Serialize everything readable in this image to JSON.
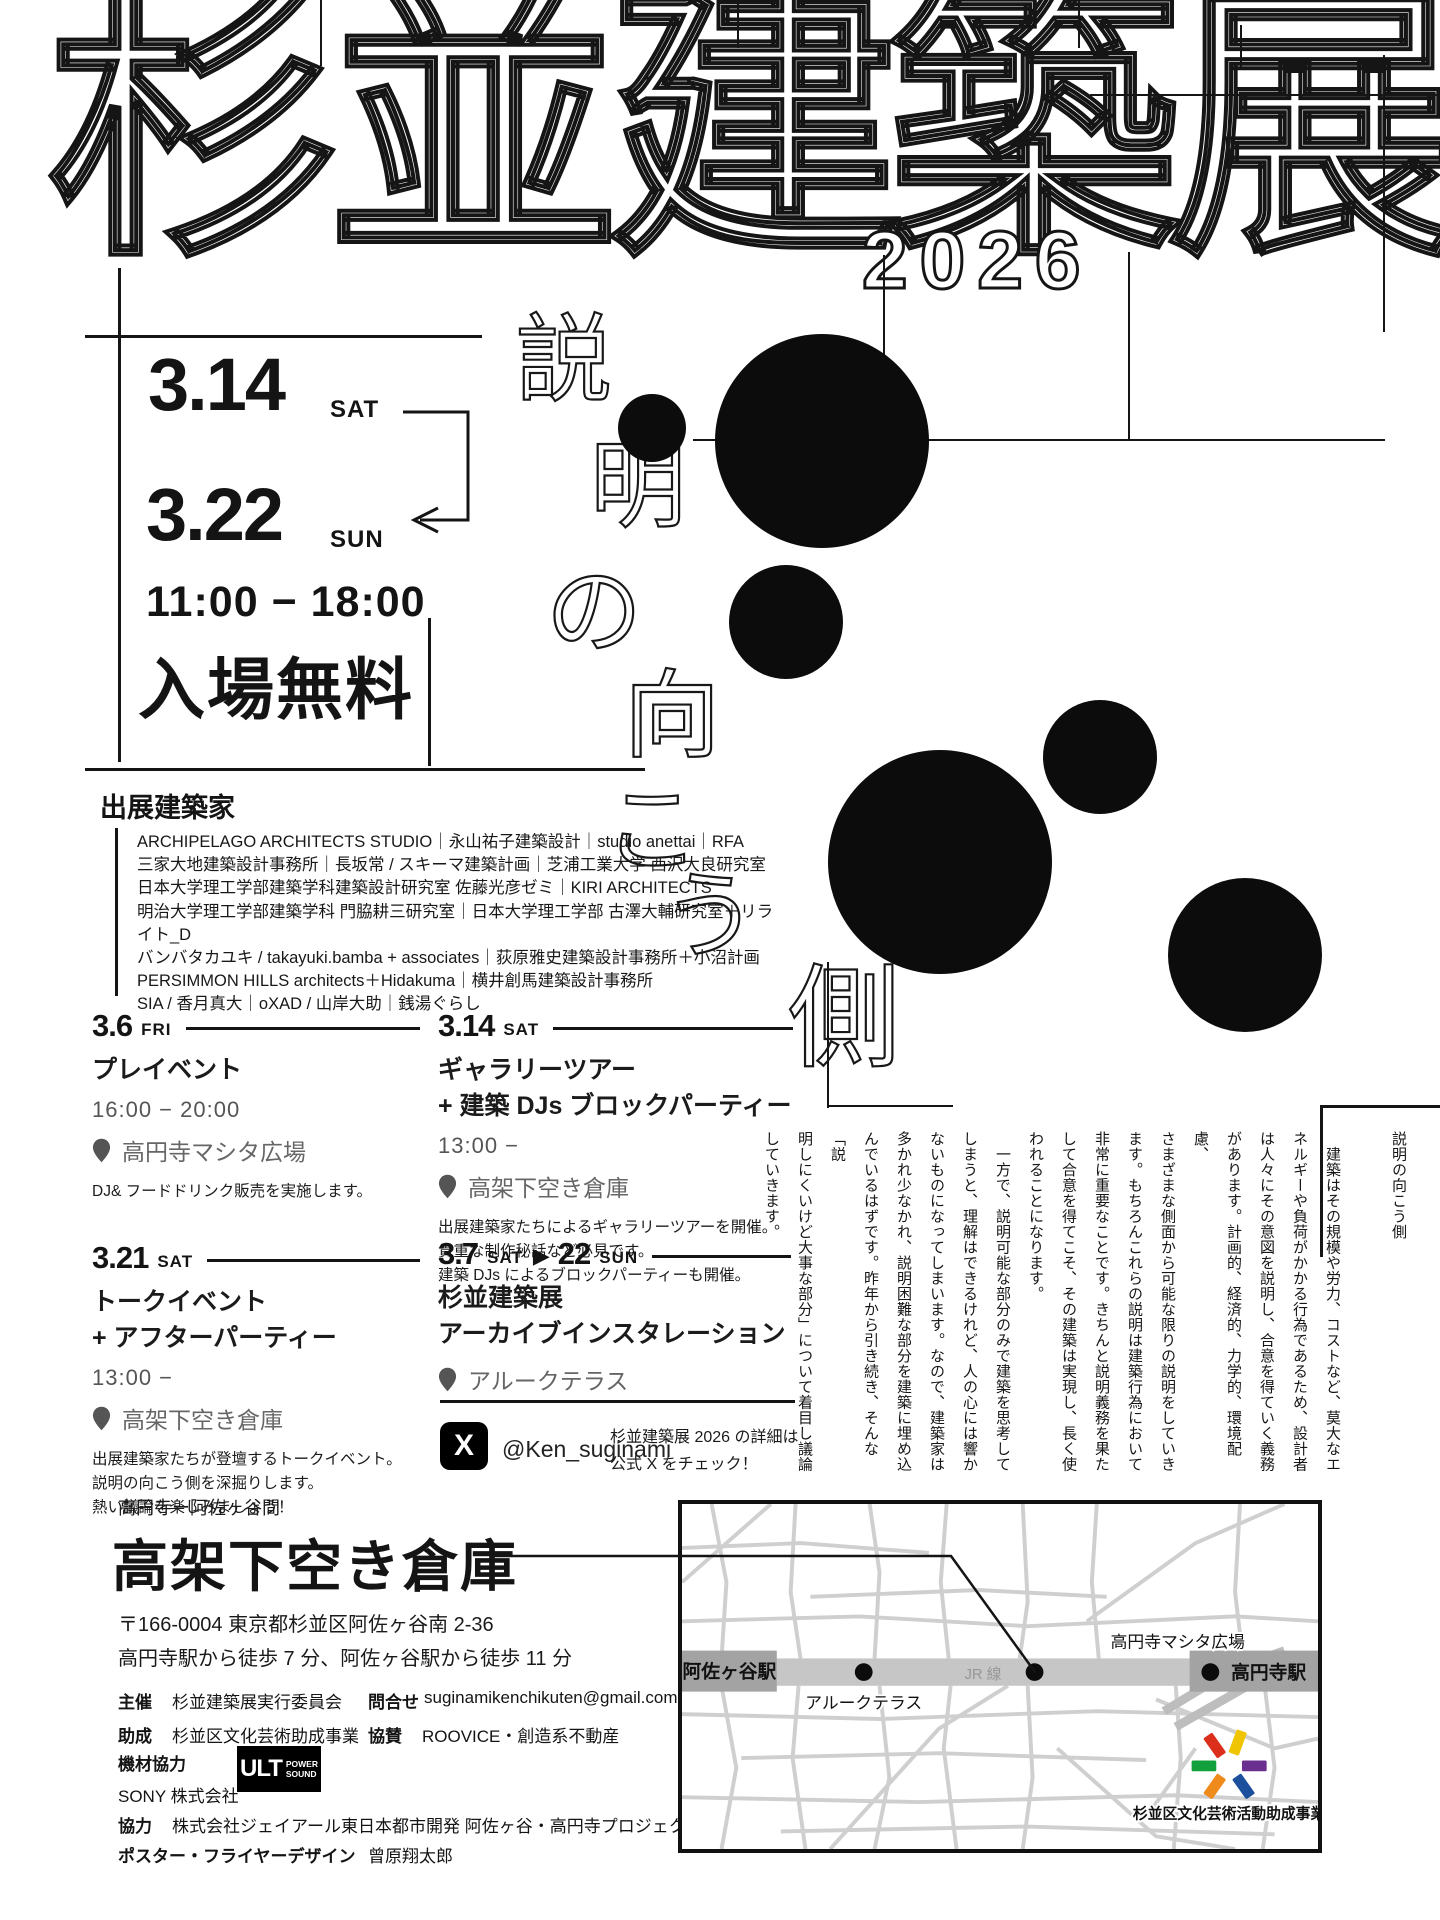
{
  "poster": {
    "logo": {
      "title": "杉並建築展",
      "year": "2026"
    },
    "theme": {
      "vertical": "説明の向こう側"
    },
    "info": {
      "start_date": "3.14",
      "start_day": "SAT",
      "end_date": "3.22",
      "end_day": "SUN",
      "hours": "11:00 − 18:00",
      "admission": "入場無料"
    },
    "architects": {
      "heading": "出展建築家",
      "lines": [
        "ARCHIPELAGO ARCHITECTS STUDIO｜永山祐子建築設計｜studio anettai｜RFA",
        "三家大地建築設計事務所｜長坂常 / スキーマ建築計画｜芝浦工業大学 西沢大良研究室",
        "日本大学理工学部建築学科建築設計研究室 佐藤光彦ゼミ｜KIRI ARCHITECTS",
        "明治大学理工学部建築学科 門脇耕三研究室｜日本大学理工学部 古澤大輔研究室＋リライト_D",
        "バンバタカユキ / takayuki.bamba + associates｜荻原雅史建築設計事務所＋小沼計画",
        "PERSIMMON HILLS architects＋Hidakuma｜横井創馬建築設計事務所",
        "SIA / 香月真大｜oXAD / 山岸大助｜銭湯ぐらし"
      ]
    },
    "events": [
      {
        "date": "3.6",
        "day": "FRI",
        "title": [
          "プレイベント"
        ],
        "time": "16:00 − 20:00",
        "venue": "高円寺マシタ広場",
        "desc": [
          "DJ& フードドリンク販売を実施します。"
        ]
      },
      {
        "date": "3.14",
        "day": "SAT",
        "title": [
          "ギャラリーツアー",
          "+ 建築 DJs ブロックパーティー"
        ],
        "time": "13:00 −",
        "venue": "高架下空き倉庫",
        "desc": [
          "出展建築家たちによるギャラリーツアーを開催。",
          "貴重な制作秘話など必見です。",
          "建築 DJs によるブロックパーティーも開催。"
        ]
      },
      {
        "date": "3.21",
        "day": "SAT",
        "title": [
          "トークイベント",
          "+ アフターパーティー"
        ],
        "time": "13:00 −",
        "venue": "高架下空き倉庫",
        "desc": [
          "出展建築家たちが登壇するトークイベント。",
          "説明の向こう側を深掘りします。",
          "熱い議論を楽しみましょう！"
        ]
      },
      {
        "date": "3.7",
        "day": "SAT",
        "range_sep": "▶",
        "date2": "22",
        "day2": "SUN",
        "title": [
          "杉並建築展",
          "アーカイブインスタレーション"
        ],
        "venue": "アルークテラス",
        "desc": []
      }
    ],
    "sns": {
      "x_glyph": "X",
      "handle": "@Ken_suginami",
      "note": [
        "杉並建築展 2026 の詳細は",
        "公式 X をチェック！"
      ]
    },
    "essay": {
      "columns": [
        "説明の向こう側",
        "",
        "　建築はその規模や労力、コストなど、莫大なエ",
        "ネルギーや負荷がかかる行為であるため、設計者",
        "は人々にその意図を説明し、合意を得ていく義務",
        "があります。計画的、経済的、力学的、環境配慮、",
        "さまざまな側面から可能な限りの説明をしていき",
        "ます。もちろんこれらの説明は建築行為において",
        "非常に重要なことです。きちんと説明義務を果た",
        "して合意を得てこそ、その建築は実現し、長く使",
        "われることになります。",
        "　一方で、説明可能な部分のみで建築を思考して",
        "しまうと、理解はできるけれど、人の心には響か",
        "ないものになってしまいます。なので、建築家は",
        "多かれ少なかれ、説明困難な部分を建築に埋め込",
        "んでいるはずです。昨年から引き続き、そんな「説",
        "明しにくいけど大事な部分」について着目し議論",
        "していきます。"
      ]
    },
    "venue": {
      "route": "高円寺ー阿佐ヶ谷間",
      "name": "高架下空き倉庫",
      "postal_address": "〒166-0004 東京都杉並区阿佐ヶ谷南 2-36",
      "access": "高円寺駅から徒歩 7 分、阿佐ヶ谷駅から徒歩 11 分"
    },
    "credits": {
      "organizer_label": "主催",
      "organizer": "杉並建築展実行委員会",
      "contact_label": "問合せ",
      "contact": "suginamikenchikuten@gmail.com",
      "grant_label": "助成",
      "grant": "杉並区文化芸術助成事業",
      "sponsor_label": "協賛",
      "sponsor": "ROOVICE・創造系不動産",
      "equipment_label": "機材協力",
      "equipment_company": "SONY 株式会社",
      "ult_logo": {
        "big": "ULT",
        "line1": "POWER",
        "line2": "SOUND"
      },
      "cooperation_label": "協力",
      "cooperation": "株式会社ジェイアール東日本都市開発 阿佐ヶ谷・高円寺プロジェクト",
      "design_label": "ポスター・フライヤーデザイン",
      "design": "曾原翔太郎"
    },
    "map": {
      "station_left": "阿佐ヶ谷駅",
      "station_right": "高円寺駅",
      "line_label": "JR 線",
      "terrace": "アルークテラス",
      "plaza": "高円寺マシタ広場",
      "grant_logo_label": "杉並区文化芸術活動助成事業",
      "grant_logo_colors": [
        "#dc2f1b",
        "#efc400",
        "#12a03c",
        "#6a3090",
        "#ef8a1d",
        "#1c4f9c"
      ]
    }
  }
}
